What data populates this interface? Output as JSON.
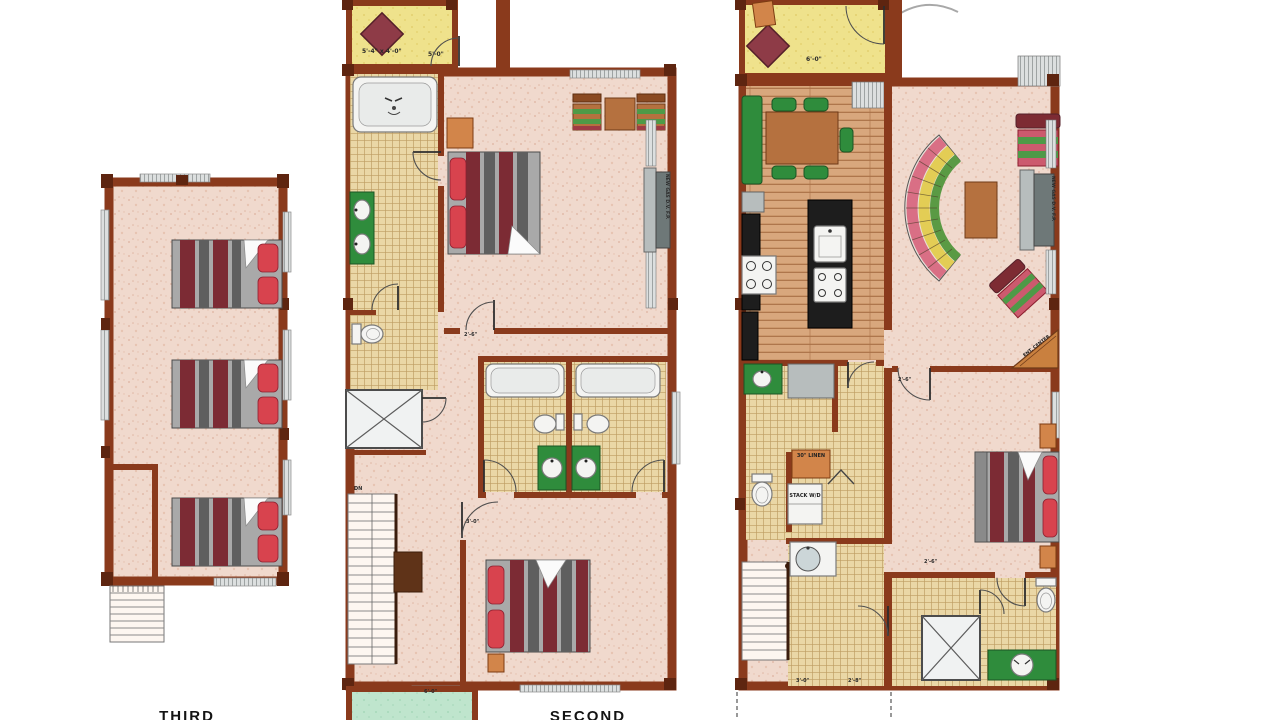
{
  "palette": {
    "wall": "#8a3a1c",
    "wall_dark": "#5e2510",
    "floor_pink": "#f0d9cd",
    "tile": "#ead7a6",
    "wood": "#d8a77d",
    "deck_yellow": "#efe28c",
    "deck_green": "#bfe5cd",
    "bed_red": "#d8434e",
    "stripe_red": "#7c2b34",
    "furniture_green": "#2f8c3c",
    "table_brown": "#b5713f",
    "counter_black": "#1d1d1d",
    "sofa_pink": "#d96f85",
    "sofa_yellow": "#e3cd55",
    "sofa_green": "#5a9a44"
  },
  "plans": {
    "third": {
      "label": "THIRD"
    },
    "second": {
      "label": "SECOND",
      "deck_dim": "5'-4\" x 4'-0\"",
      "deck_door_dim": "5'-0\"",
      "stairs_label": "DN",
      "fireplace_label": "NEW GAS D.V. F.P.",
      "balcony_door_dim": "6'-0\"",
      "master_door_dim": "2'-6\"",
      "bedroom_door_dim": "3'-0\""
    },
    "first": {
      "deck_door_dim": "6'-0\"",
      "fireplace_label": "NEW GAS D.V. F.P.",
      "ent_center_label": "ENT. CENTER",
      "linen_label": "30\" LINEN",
      "washer_dryer_label": "STACK W/D",
      "bedroom_door_dim": "2'-6\"",
      "bath_door_dim": "2'-6\"",
      "entry_door_dim": "3'-0\"",
      "closet_door_dim": "2'-8\""
    }
  }
}
